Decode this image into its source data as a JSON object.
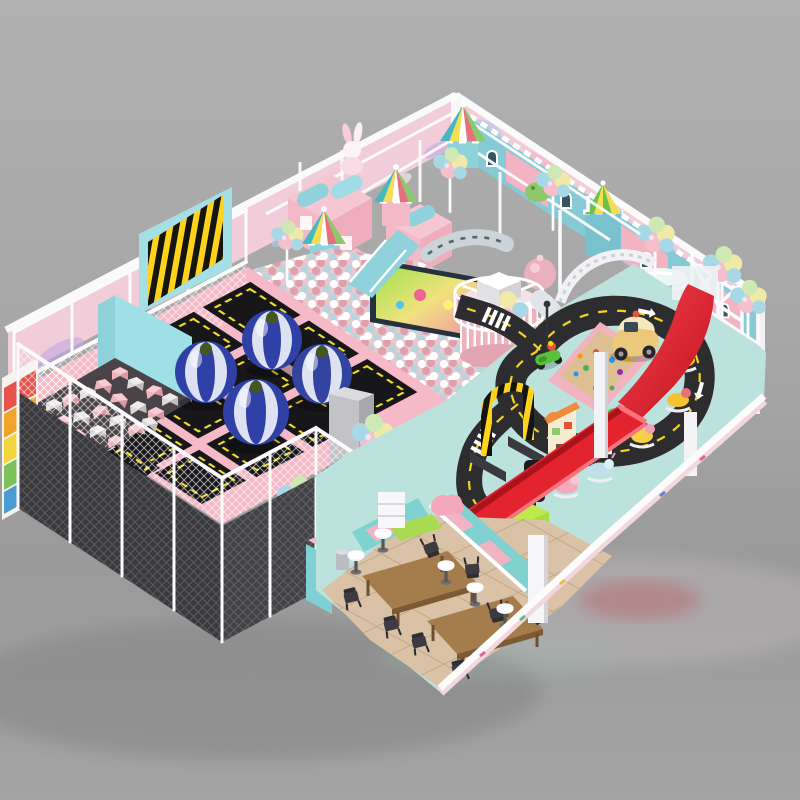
{
  "scene": {
    "type": "3d-architectural-render",
    "subject": "indoor soft-play and trampoline park",
    "view": "isometric overview on gray studio background",
    "background_top": "#aeaeae",
    "background_bottom": "#989898"
  },
  "palette": {
    "wall_pink": "#f1ccd9",
    "beam_white": "#fafafa",
    "platform_pink": "#f5b9c8",
    "tramp_mat": "#17171a",
    "tramp_border": "#f2dd2e",
    "floor_teal": "#bce2de",
    "road_asphalt": "#2d2d30",
    "road_line": "#f7d21f",
    "slide_red": "#e3232e",
    "sand": "#dcbf92",
    "cafe_tile": "#d9c2a5",
    "table_wood": "#a57c4b",
    "facade_blue": "#85cad4",
    "facade_pink": "#f2b4c3",
    "walkway_gray": "#909094",
    "foam_cyan": "#9fdfe6",
    "foam_pink": "#e7a9b2",
    "foam_gray": "#d6d2d4",
    "ball_pink": "#dfa0ab",
    "ball_blue": "#b5d6de",
    "ball_white": "#ffffff",
    "bumper_blue": "#2f41a6",
    "scooter_green": "#57c23e",
    "carwash_green": "#8fd23c",
    "light_red": "#e63832",
    "light_yellow": "#f5c518",
    "light_green": "#3fae4c",
    "balloon_pink": "#f4c0ce",
    "balloon_yellow": "#f0e9a8",
    "balloon_blue": "#a8d8e6",
    "balloon_green": "#cfe9b4",
    "cloud_purple": "#c3a8e2",
    "cloud_blue": "#a9cdf0",
    "cloud_pink": "#f7b4ca"
  },
  "areas": [
    {
      "id": "trampoline-zone",
      "label": "Trampoline zone",
      "trampoline_beds": 10,
      "bumper_balls": 4
    },
    {
      "id": "foam-pit",
      "label": "Foam cube pit",
      "cube_colors": [
        "pink",
        "gray",
        "white"
      ]
    },
    {
      "id": "ballpit-castle",
      "label": "Ball pit castle",
      "carousel_tents": 4,
      "mini_houses": 3,
      "screen": "cartoon video wall"
    },
    {
      "id": "right-castle-facade",
      "label": "Blue castle facade",
      "balcony_towers": 1,
      "balloon_clusters": 4
    },
    {
      "id": "red-slide",
      "label": "Red wave slide with long run-out"
    },
    {
      "id": "driving-school",
      "label": "Toddler driving circuit",
      "scooters": 4,
      "rocking_animals": 5,
      "sandbox": 1,
      "traffic_light": 1,
      "gate": 1,
      "car_wash": 1
    },
    {
      "id": "cafe",
      "label": "Parent cafe",
      "tables": 2,
      "chairs": 8,
      "stools": 5
    }
  ]
}
